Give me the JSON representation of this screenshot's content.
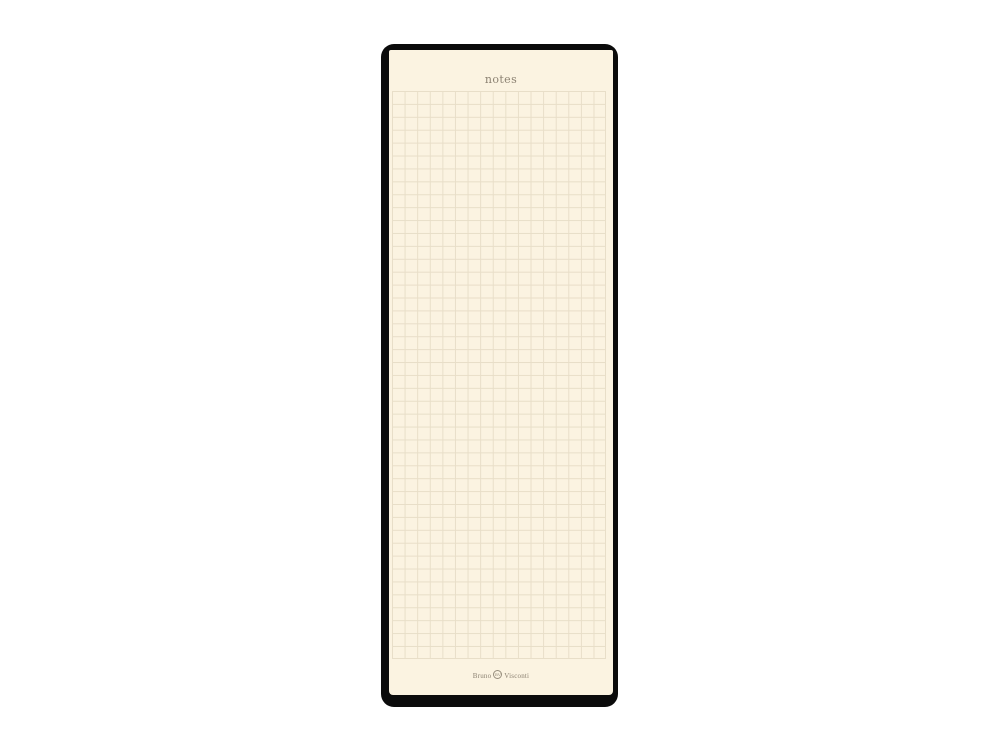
{
  "scene": {
    "description": "product photo of a squared notes pad on white background",
    "background_color": "#ffffff"
  },
  "notepad": {
    "header_label": "notes",
    "brand": {
      "word_first": "Bruno",
      "word_second": "Visconti",
      "monogram": "BV"
    },
    "colors": {
      "frame": "#0b0b0b",
      "paper": "#fbf3e1",
      "grid_line": "#e8dec8",
      "text": "#8c8272"
    },
    "grid": {
      "pattern": "squared",
      "cell_size_px": 12.8,
      "columns": 17,
      "rows": 44
    }
  }
}
